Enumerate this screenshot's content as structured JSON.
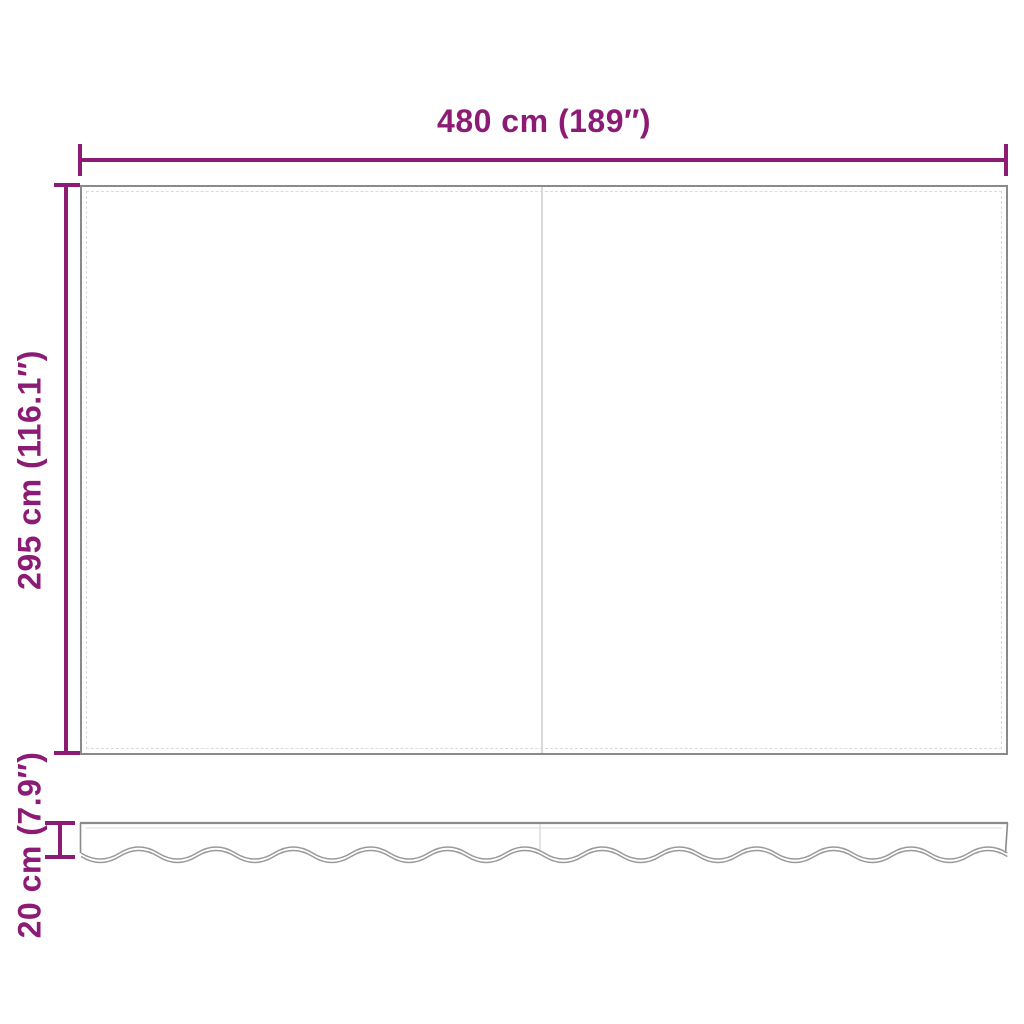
{
  "labels": {
    "width": "480 cm (189″)",
    "height": "295 cm (116.1″)",
    "valance_height": "20 cm (7.9″)"
  },
  "colors": {
    "dimension_accent": "#8C1B76",
    "fabric_outline": "#8A8A8A",
    "stitch_line": "#DBDBDB",
    "seam_line": "#D9D9D9",
    "wave_line": "#9A9A9A",
    "background": "#FFFFFF"
  }
}
